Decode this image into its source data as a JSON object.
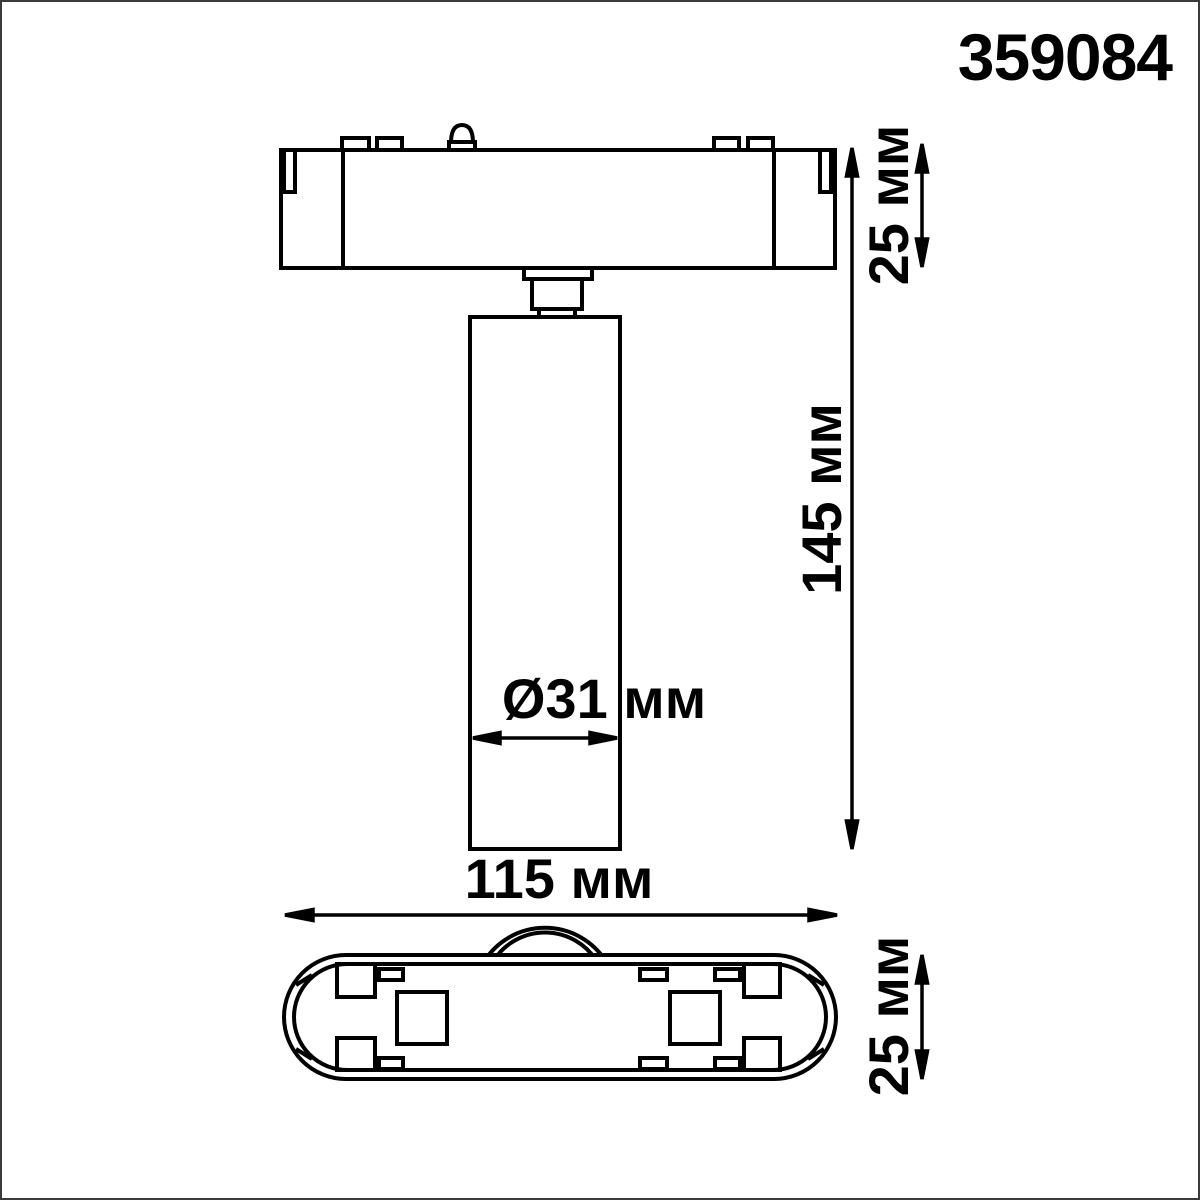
{
  "page": {
    "title": "359084"
  },
  "drawing": {
    "kind": "product-dimension-diagram",
    "views": {
      "front": "front-view-of-track-spot-light",
      "bottom": "bottom-view-of-track-base"
    }
  },
  "dimensions": {
    "track_height": {
      "label": "25 мм",
      "value": 25,
      "unit": "мм"
    },
    "fixture_height": {
      "label": "145 мм",
      "value": 145,
      "unit": "мм"
    },
    "cylinder_diameter": {
      "label": "Ø31 мм",
      "value": 31,
      "unit": "мм"
    },
    "base_length": {
      "label": "115 мм",
      "value": 115,
      "unit": "мм"
    },
    "base_height": {
      "label": "25 мм",
      "value": 25,
      "unit": "мм"
    }
  },
  "colors": {
    "line": "#000000",
    "background": "#ffffff",
    "page_border": "#3a3a3a"
  }
}
